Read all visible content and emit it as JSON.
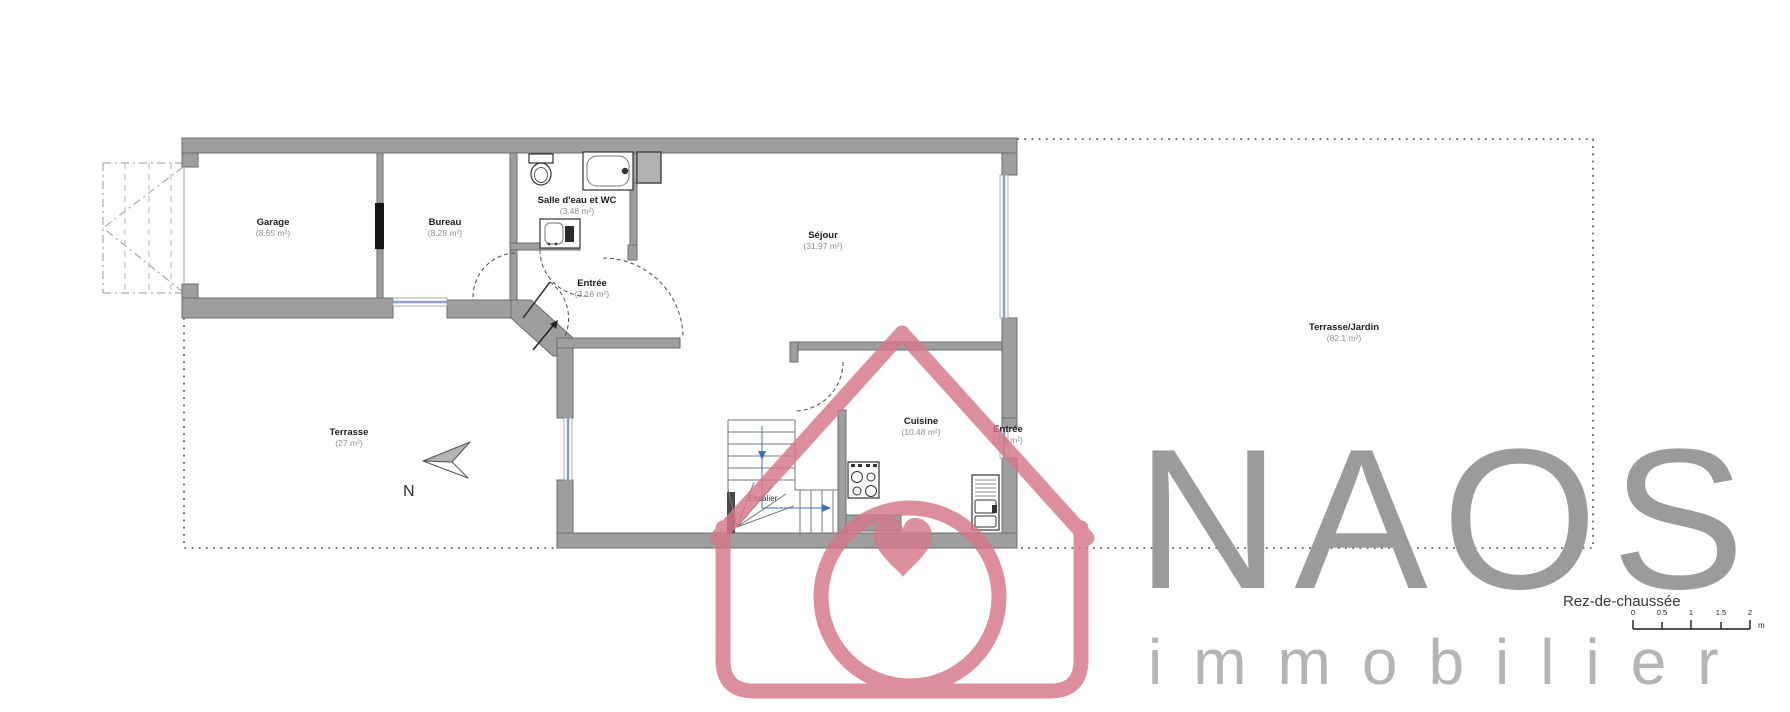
{
  "plan": {
    "title": "Rez-de-chaussée",
    "north_label": "N",
    "rooms": [
      {
        "name": "Garage",
        "area": "(8.65 m²)"
      },
      {
        "name": "Bureau",
        "area": "(8.28 m²)"
      },
      {
        "name": "Salle d'eau et WC",
        "area": "(3.48 m²)"
      },
      {
        "name": "Entrée",
        "area": "(3.16 m²)"
      },
      {
        "name": "Séjour",
        "area": "(31.97 m²)"
      },
      {
        "name": "Cuisine",
        "area": "(10.48 m²)"
      },
      {
        "name": "Entrée",
        "area": "(3.4 m²)"
      },
      {
        "name": "Terrasse",
        "area": "(27 m²)"
      },
      {
        "name": "Terrasse/Jardin",
        "area": "(82.1 m²)"
      },
      {
        "name": "Escalier",
        "area": ""
      }
    ],
    "scale_bar": {
      "ticks": [
        "0",
        "0.5",
        "1",
        "1.5",
        "2"
      ],
      "unit": "m"
    }
  },
  "watermark": {
    "brand": "NAOS",
    "subtitle": "immobilier"
  },
  "colors": {
    "wall_fill": "#9e9e9e",
    "wall_edge": "#6d6d6d",
    "window_blue": "#8f9fd4",
    "stair_arrow_blue": "#3f6fc4",
    "watermark_pink": "#d57687",
    "brand_gray": "#9b9b9b",
    "subtitle_gray": "#b4b4b4"
  }
}
